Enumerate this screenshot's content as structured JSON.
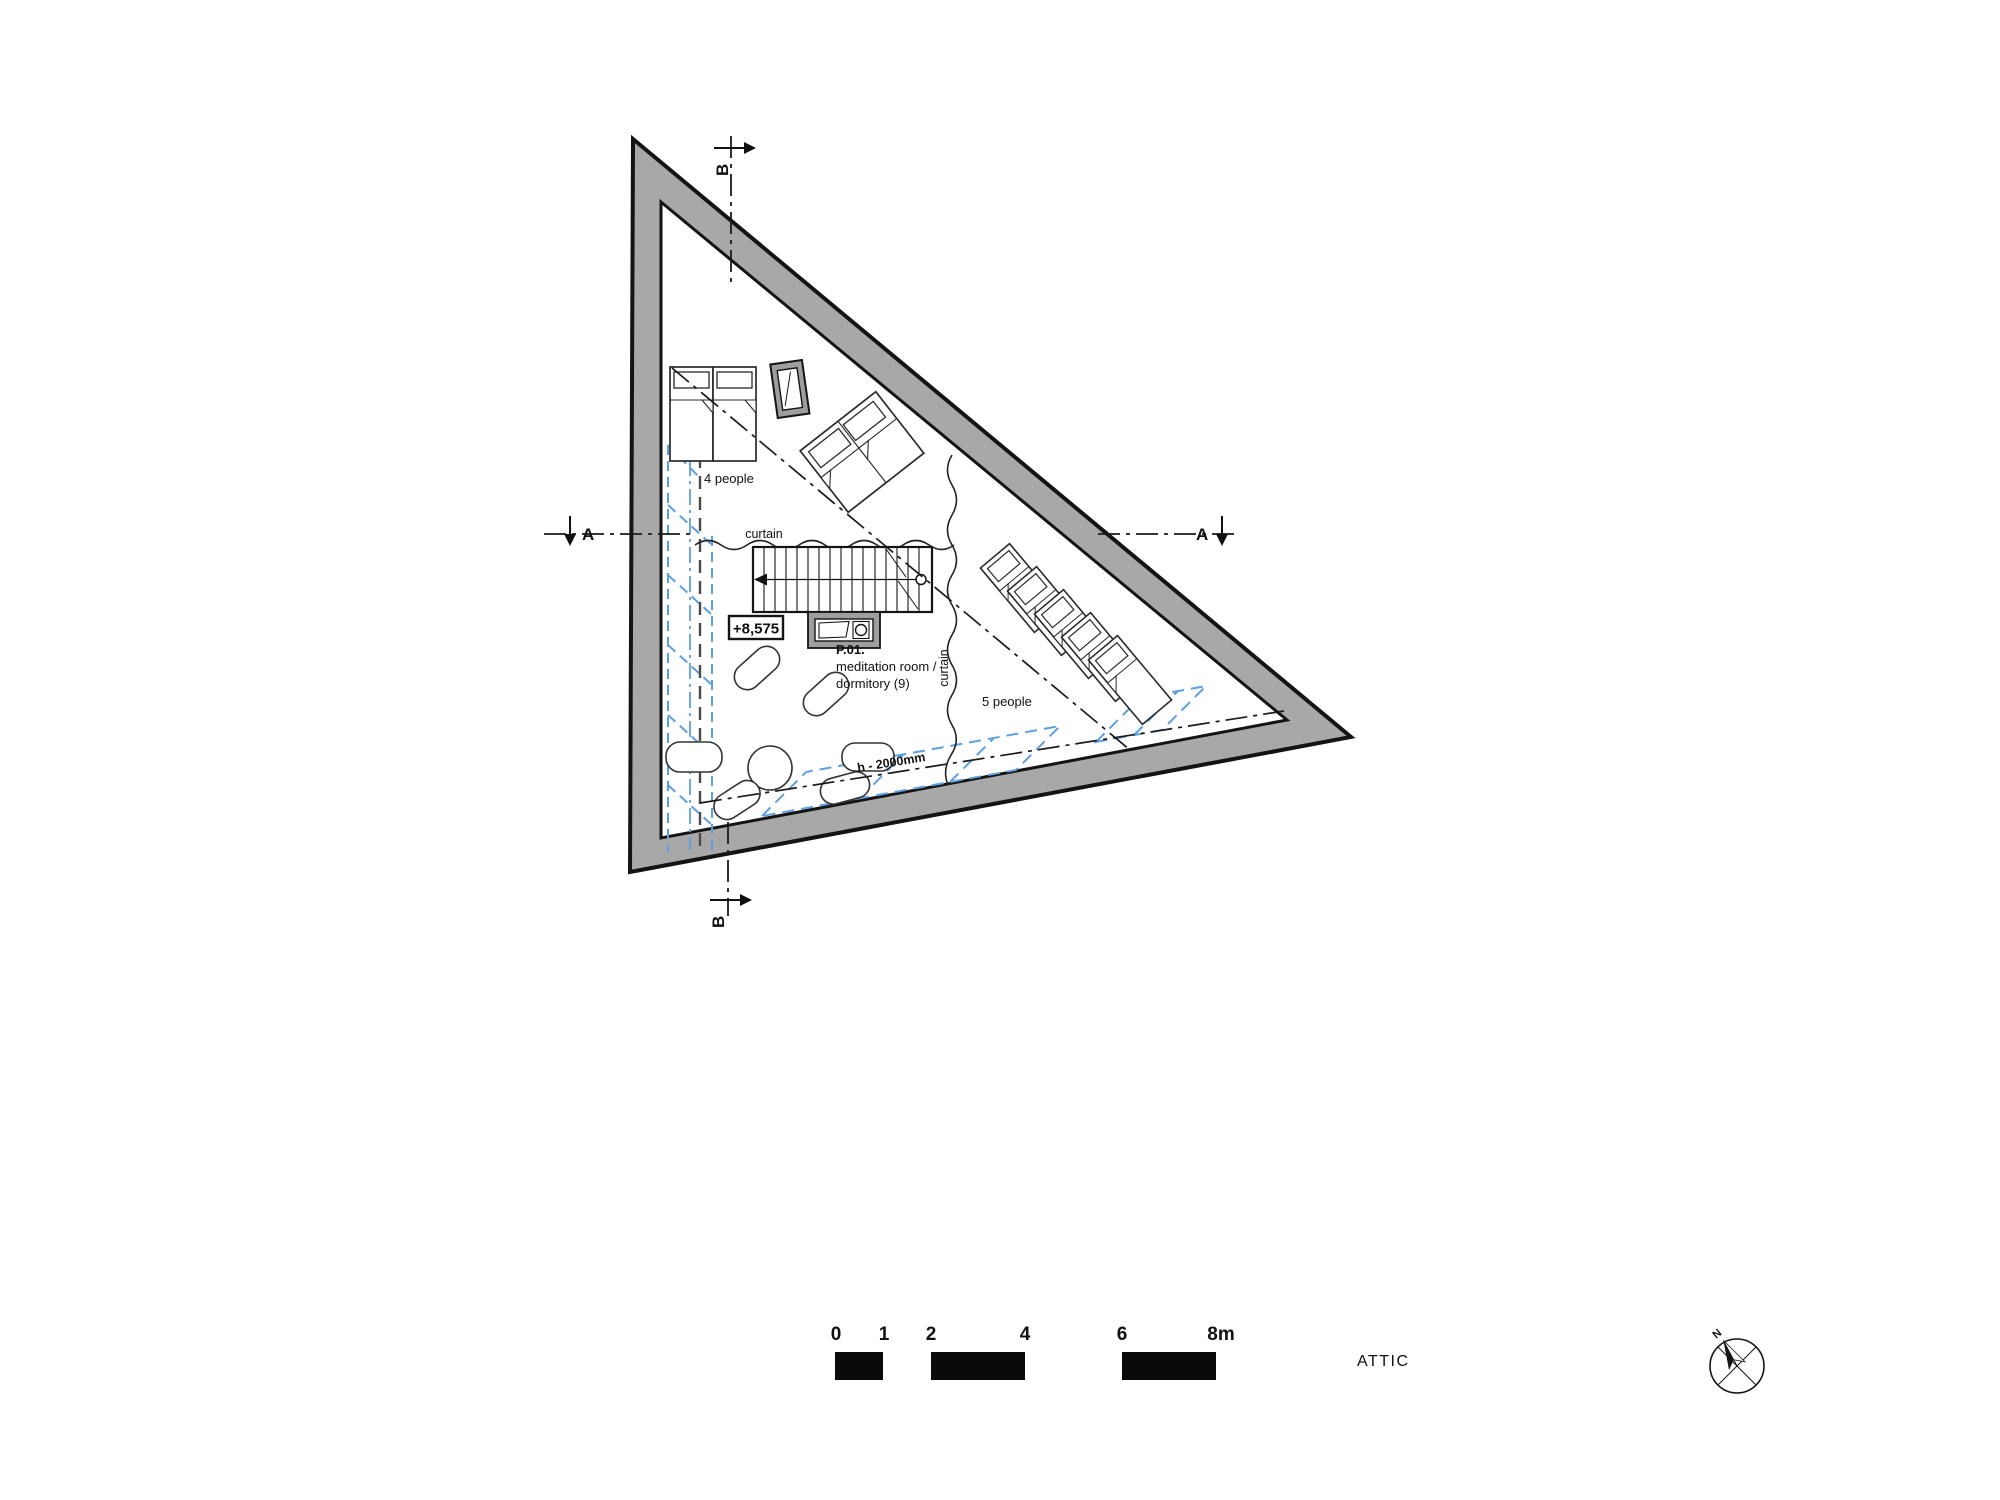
{
  "colors": {
    "wall_fill": "#a8a8a8",
    "frame_gray": "#9e9e9e",
    "line": "#141414",
    "low_headroom_blue": "#5d9fe0",
    "dash_gray": "#4a4a4a",
    "bar_black": "#0a0a0a"
  },
  "plan": {
    "level_marker": "+8,575",
    "room_label": {
      "number": "P.01.",
      "line1": "meditation room /",
      "line2": "dormitory  (9)"
    },
    "capacity_top": "4 people",
    "capacity_right": "5 people",
    "curtain_top": "curtain",
    "curtain_right": "curtain",
    "headroom_note": "h - 2000mm",
    "section_a": "A",
    "section_b": "B"
  },
  "footer": {
    "floor_label": "ATTIC",
    "scale_ticks": [
      "0",
      "1",
      "2",
      "4",
      "6",
      "8m"
    ],
    "north_label": "N"
  }
}
